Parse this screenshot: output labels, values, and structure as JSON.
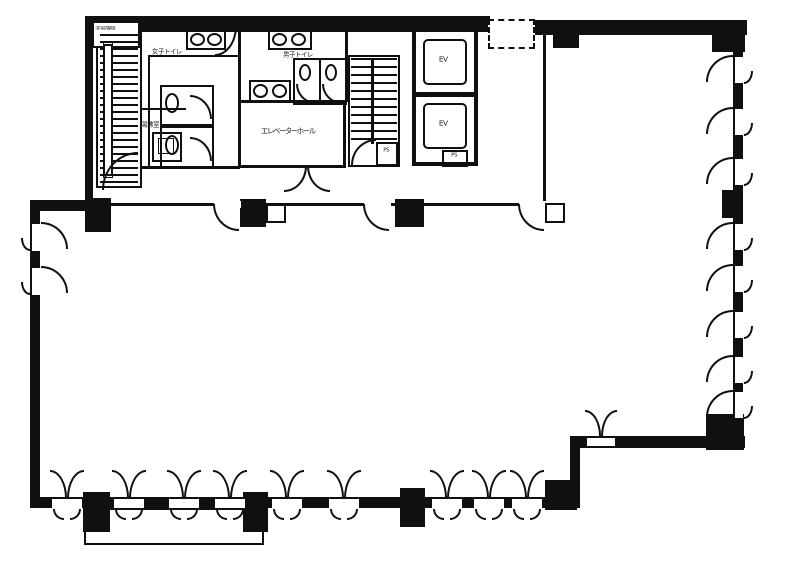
{
  "plan": {
    "title": "office-floor-plan",
    "colors": {
      "ink": "#161616",
      "paper": "#fcfcfc"
    },
    "labels": {
      "emergency_stair": "非常階段",
      "womens_toilet": "女子トイレ",
      "mens_toilet": "男子トイレ",
      "kitchenette": "湯沸室",
      "central_room": "エレベーターホール",
      "elevator_1": "EV",
      "elevator_2": "EV",
      "pipe_shaft_stair": "PS",
      "pipe_shaft_ev": "PS"
    },
    "legend": {
      "window_symbol": "casement-window-icon",
      "door_symbol": "door-swing-icon",
      "column_symbol": "structural-column",
      "stair_symbol": "stair-treads"
    }
  }
}
